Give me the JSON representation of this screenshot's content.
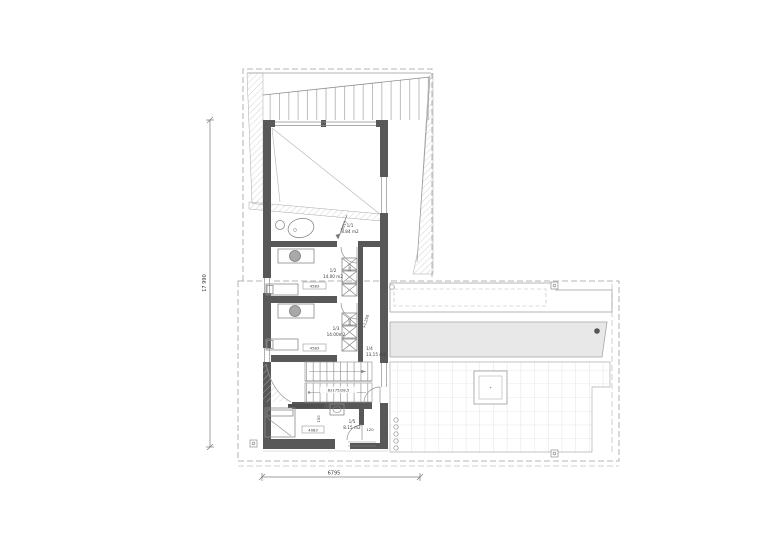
{
  "document": {
    "kind": "architectural-floor-plan"
  },
  "colors": {
    "wall": "#585858",
    "line": "#8f8f8f",
    "light": "#bdbdbd",
    "pool_fill": "#e8e8e8",
    "text": "#3a3a3a"
  },
  "rooms": [
    {
      "id": "1/1",
      "area": "8.84 m2"
    },
    {
      "id": "1/2",
      "area": "14.00 m2",
      "width": "4583",
      "door": "300"
    },
    {
      "id": "1/3",
      "area": "14.00m2",
      "width": "4583",
      "door": "300"
    },
    {
      "id": "1/4",
      "area": "13,15 m2",
      "level": "+1,250"
    },
    {
      "id": "1/5",
      "area": "8.15 m2",
      "width": "4083",
      "door": "120",
      "fixture": "150"
    }
  ],
  "dimensions": {
    "overall_height": "17 990",
    "overall_width": "6795",
    "diagonal": "5015"
  },
  "stairs": {
    "spec": "8x175/28,5"
  }
}
